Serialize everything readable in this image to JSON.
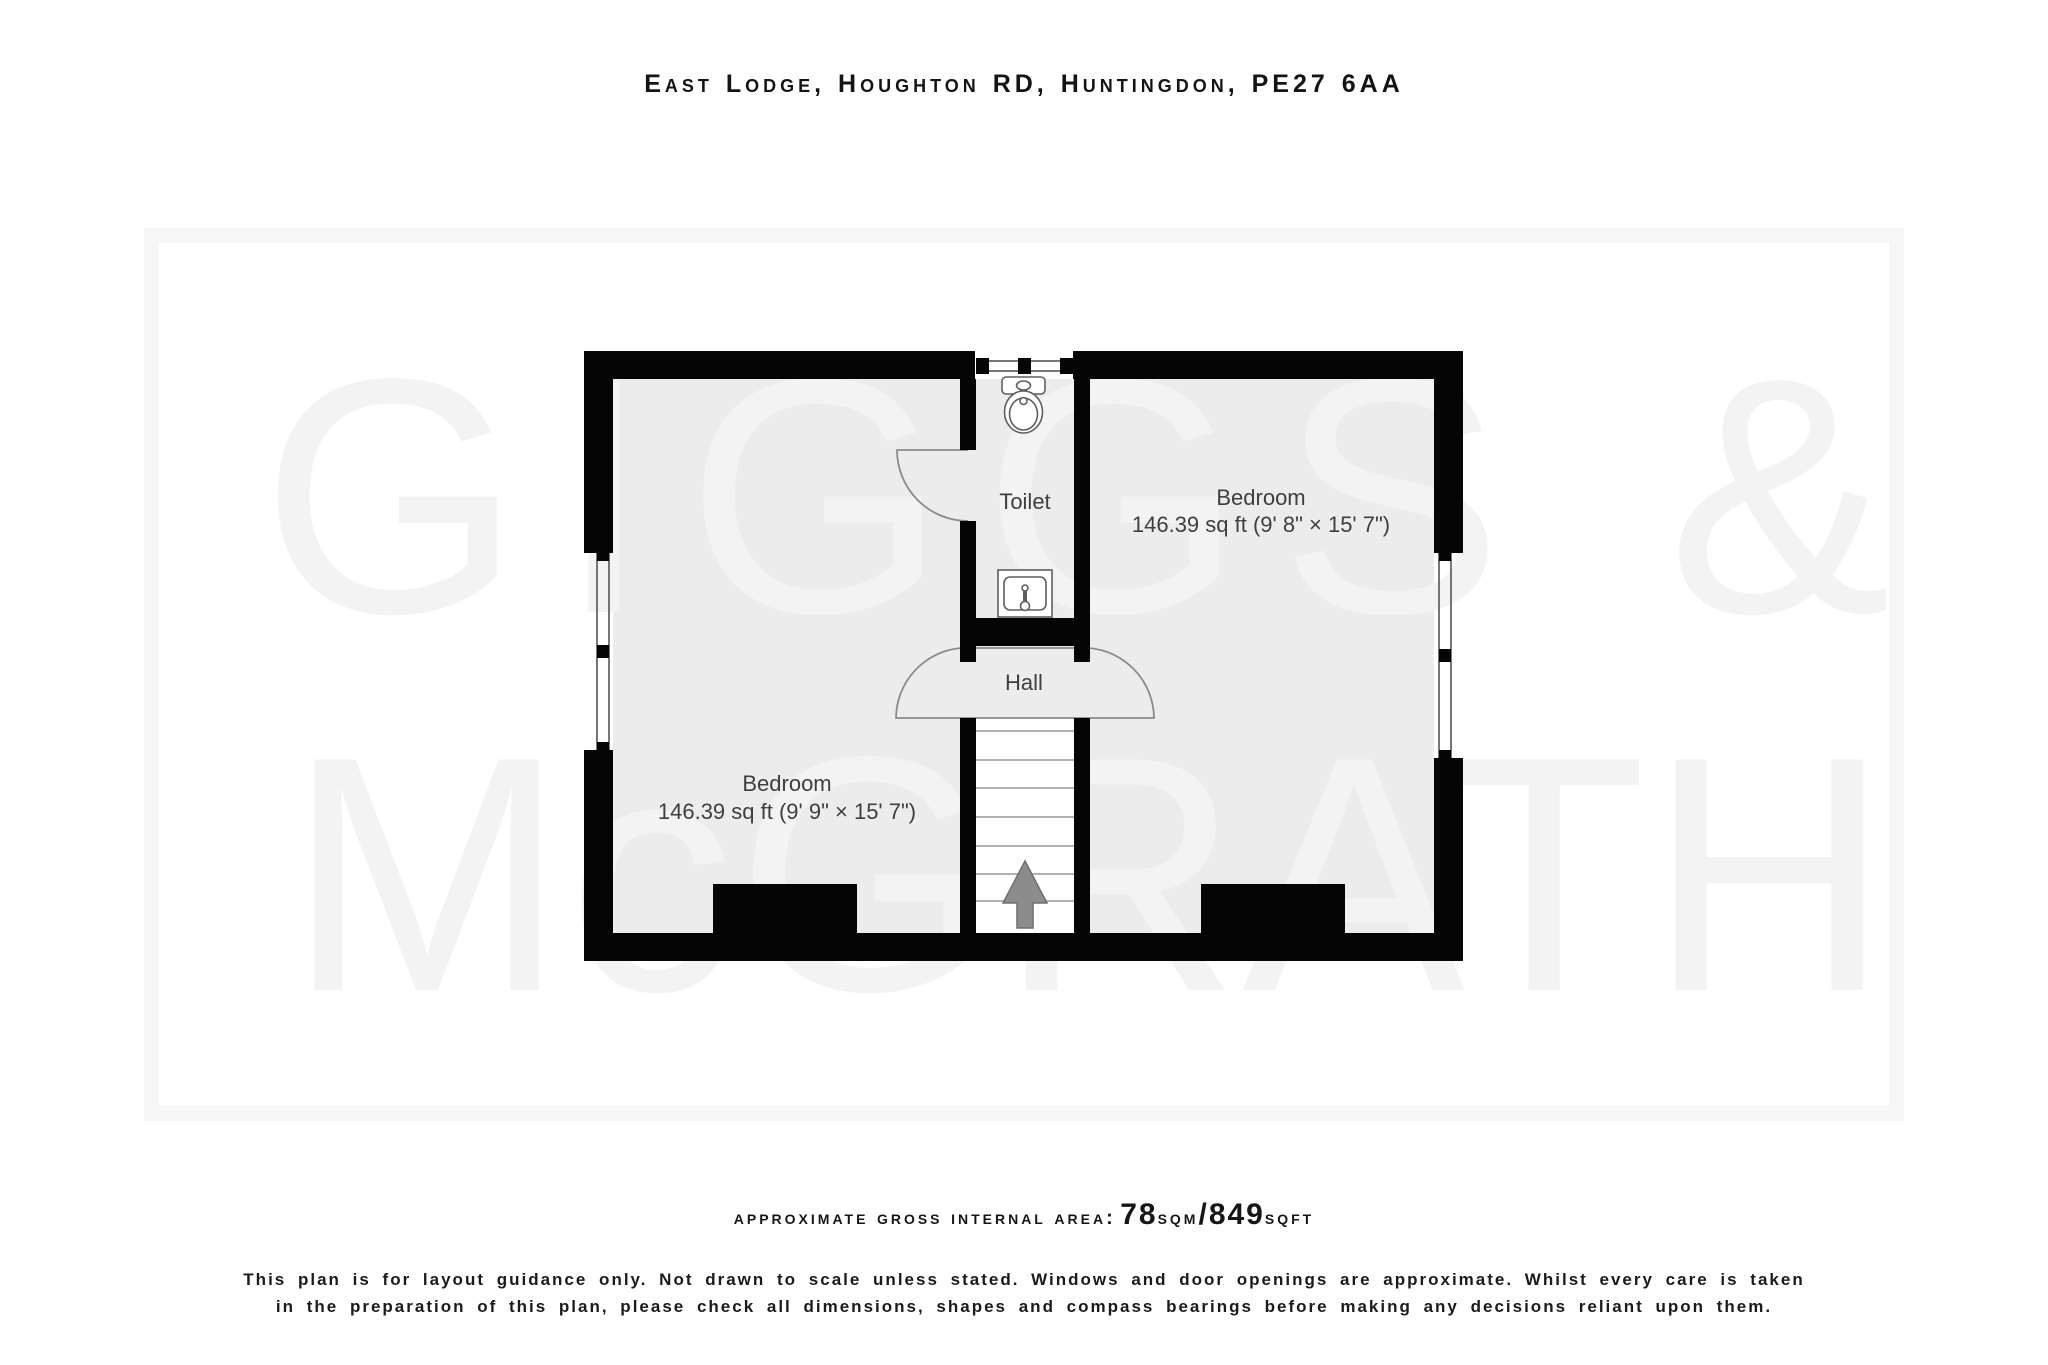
{
  "title": "East Lodge, Houghton RD, Huntingdon, PE27 6AA",
  "watermark": {
    "line1": "GIGGS &",
    "line2": "McGRATH"
  },
  "rooms": {
    "bedroom_left": {
      "name": "Bedroom",
      "size": "146.39 sq ft (9' 9\" × 15' 7\")"
    },
    "bedroom_right": {
      "name": "Bedroom",
      "size": "146.39 sq ft (9' 8\" × 15' 7\")"
    },
    "toilet": {
      "name": "Toilet"
    },
    "hall": {
      "name": "Hall"
    }
  },
  "footer": {
    "area_label": "approximate gross internal area:",
    "area_sqm_value": "78",
    "area_sqm_unit": "sqm",
    "area_separator": "/",
    "area_sqft_value": "849",
    "area_sqft_unit": "sqft",
    "disclaimer_line1": "This plan is for layout guidance only. Not drawn to scale unless stated. Windows and door openings are approximate. Whilst every care is taken",
    "disclaimer_line2": "in the preparation of this plan, please check all dimensions, shapes and compass bearings before making any decisions reliant upon them."
  },
  "colors": {
    "wall": "#050505",
    "room_fill": "#ececed",
    "stairs_fill": "#ffffff",
    "watermark": "#f3f3f4",
    "frame": "#f6f6f6",
    "label": "#3f3f3f",
    "arrow": "#8c8c8c",
    "fixture_stroke": "#5f5f5f",
    "door_arc": "#8a8a8a"
  }
}
